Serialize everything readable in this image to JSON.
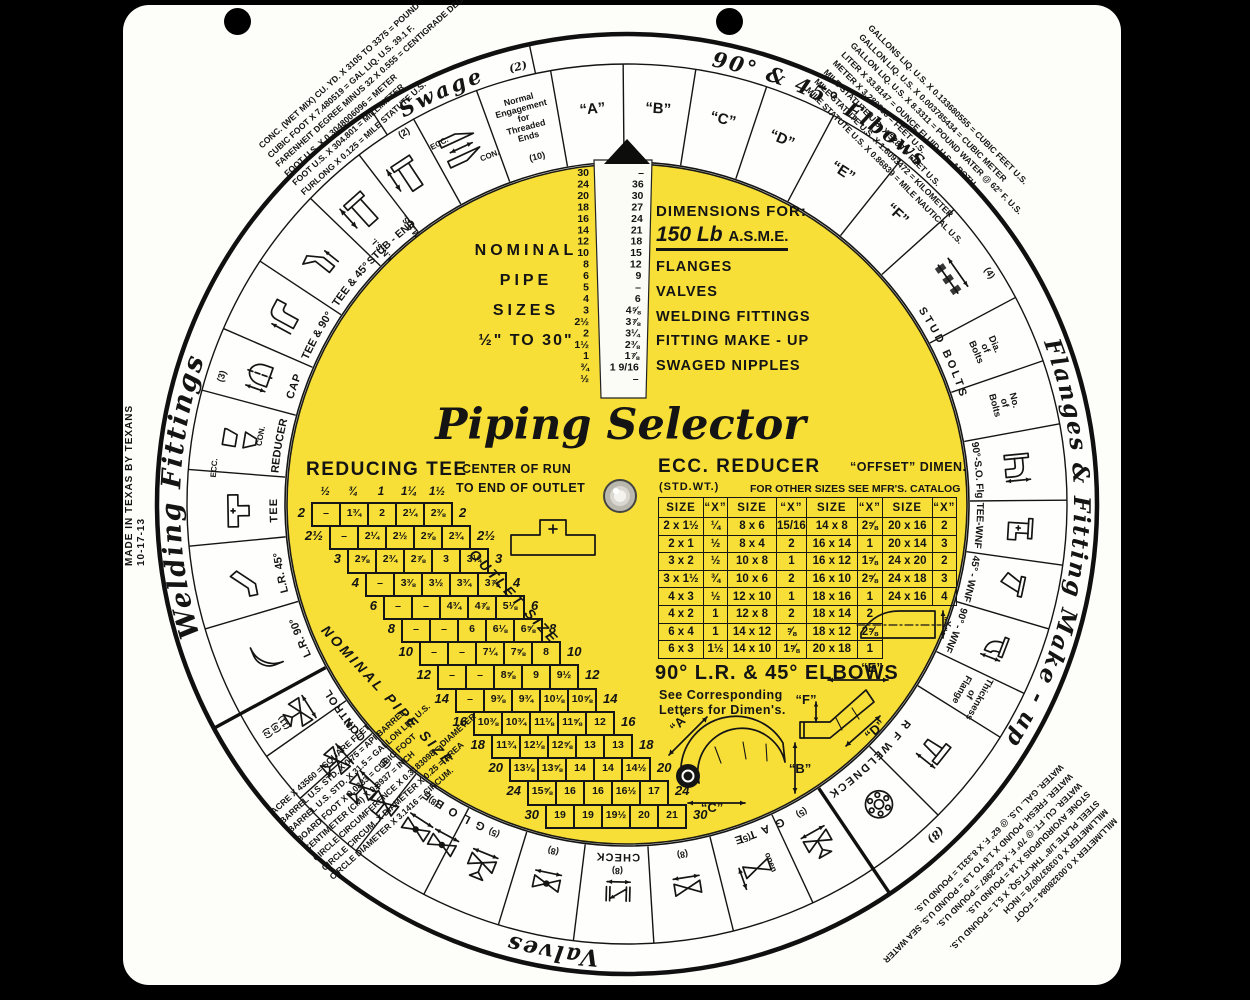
{
  "wheel": {
    "made_in": "MADE IN TEXAS BY TEXANS",
    "date_code": "10-17-13",
    "titles": {
      "welding_fittings": "Welding Fittings",
      "swage": "Swage",
      "swage_note": "(2)",
      "elbows_90_45": "90° & 45° Elbows",
      "flanges_make_up": "Flanges & Fitting Make - up",
      "flanges_note": "(8)",
      "valves": "Valves"
    },
    "letter_cells": [
      "“A”",
      "“B”",
      "“C”",
      "“D”",
      "“E”",
      "“F”"
    ],
    "cells": {
      "stub_end": "STUB - END",
      "ansi": "A.N.S.I.",
      "mss": "M.S.S.",
      "tee_45": "TEE & 45°",
      "tee_90": "TEE & 90°",
      "cap": "CAP",
      "reducer": "REDUCER",
      "ecc": "ECC.",
      "con": "CON.",
      "tee": "TEE",
      "lr_45": "L.R. 45°",
      "lr_90": "L.R. 90°",
      "control": "CONTROL",
      "globe": "GLOBE",
      "check": "CHECK",
      "gate": "GATE",
      "open": "open",
      "stud_bolts": "STUD BOLTS",
      "dia_of_bolts": [
        "Dia.",
        "of",
        "Bolts"
      ],
      "no_of_bolts": [
        "No.",
        "of",
        "Bolts"
      ],
      "so_flg_90": "90°-S.O. Flg",
      "tee_wnf": "TEE-WNF",
      "wnf_45": "45° - WNF",
      "wnf_90": "90° - WNF",
      "rf_weldneck": "R F WELDNECK",
      "thickness_of_flange": [
        "Thickness",
        "of",
        "Flange"
      ],
      "engagement": [
        "Normal",
        "Engagement",
        "for",
        "Threaded",
        "Ends"
      ],
      "engagement_note": "(10)",
      "notes": {
        "n2": "(2)",
        "n3": "(3)",
        "n4": "(4)",
        "n5": "(5)",
        "n8": "(8)",
        "n10": "(10)",
        "n11": "(11)",
        "control_stack": [
          "(2)",
          "(5)",
          "(11)"
        ]
      }
    },
    "corner_conversions": {
      "top_left": [
        "CONC. (WET MIX) CU. YD. X 3105 TO 3375 = POUND",
        "CUBIC FOOT X 7.480519 = GAL LIQ. U.S. 39.1 F.",
        "FARENHEIT DEGREE MINUS 32 X 0.555 = CENTIGRADE DEGREE",
        "FOOT U.S. X 0.3048006096 = METER",
        "FOOT U.S. X 304.801 = MILLIMETER",
        "FURLONG X 0.125 = MILE STATUTE U.S."
      ],
      "top_right": [
        "GALLONS LIQ. U.S. X 0.133680555 = CUBIC FEET U.S.",
        "GALLON LIQ. U.S. X 0.003785434 = CUBIC METER",
        "GALLON LIQ. U.S. X 8.3311 = POUND WATER @ 62° F. U.S.",
        "LITER X 33.8147 = OUNCE FLUID U.S. APOTH.",
        "METER X 3.280833 = FEET U.S.",
        "MILE STATUTE U.S. X 5280 = FEET U.S.",
        "MILE STATUTE U.S. X 1.6093472 = KILOMETER",
        "MILE STATUTE U.S. X 0.86839 = MILE NAUTICAL U.S."
      ],
      "bottom_left": [
        "ACRE X 43560 = SQUARE FEET",
        "BARREL U.S. STD. X 0.75 = API BARREL",
        "BARREL U.S. STD. X 31.5 = GALLON LIQ. U.S.",
        "BOARD FOOT X 0.0833 = CUBIC FOOT",
        "CENTIMETER (CM) X 0.3937 = INCH",
        "CIRCLE CIRCUMFERENCE X 0.3183098 = DIAMETER",
        "CIRCLE CIRCUM. X DIAMETER X 0.25 = AREA",
        "CIRCLE DIAMETER X 3.1416 = CIRCUM."
      ],
      "bottom_right": [
        "MILLIMETER X 0.00328084 = FOOT",
        "MILLIMETER X 0.039370078 = INCH",
        "STEEL PLATE 1/8\" THK.FT.SQ. X 5.1 = POUND U.S.",
        "STONE AVOIRDUPOIS X 14 = POUND U.S.",
        "WATER. CU. FT. @ 70° F. X 62.2987 = POUND U.S.",
        "WATER. FRESH. POUND X 1.6 TO 1.9 = POUND U.S. SEA WATER",
        "WATER. GAL. U.S. @ 62° F. X 8.3311 = POUND U.S."
      ]
    }
  },
  "disc": {
    "title": "Piping Selector",
    "copyright": "COPYRIGHT 1998 PIPING SELECTOR",
    "nominal": {
      "l1": "NOMINAL",
      "l2": "PIPE",
      "l3": "SIZES",
      "l4": "½\" TO 30\""
    },
    "dimensions_for": {
      "heading": "DIMENSIONS FOR:",
      "spec1": "150 Lb",
      "spec2": "A.S.M.E.",
      "items": [
        "FLANGES",
        "VALVES",
        "WELDING FITTINGS",
        "FITTING MAKE - UP",
        "SWAGED NIPPLES"
      ]
    },
    "slot": {
      "sizes": [
        "30",
        "24",
        "20",
        "18",
        "16",
        "14",
        "12",
        "10",
        "8",
        "6",
        "5",
        "4",
        "3",
        "2½",
        "2",
        "1½",
        "1",
        "¾",
        "½"
      ],
      "window": [
        "–",
        "36",
        "30",
        "27",
        "24",
        "21",
        "18",
        "15",
        "12",
        "9",
        "–",
        "6",
        "4⅝",
        "3⅞",
        "3¼",
        "2⅜",
        "1⅞",
        "1 9/16",
        "–"
      ]
    },
    "reducing_tee": {
      "title": "REDUCING TEE",
      "subtitle1": "CENTER OF RUN",
      "subtitle2": "TO END OF OUTLET",
      "col_headers": [
        "½",
        "¾",
        "1",
        "1¼",
        "1½"
      ],
      "rows": [
        {
          "label": "2",
          "cells": [
            "–",
            "1¾",
            "2",
            "2¼",
            "2⅜"
          ]
        },
        {
          "label": "2½",
          "cells": [
            "–",
            "2¼",
            "2½",
            "2⅝",
            "2¾"
          ]
        },
        {
          "label": "3",
          "cells": [
            "2⅝",
            "2¾",
            "2⅞",
            "3",
            "3¼"
          ]
        },
        {
          "label": "4",
          "cells": [
            "–",
            "3⅜",
            "3½",
            "3¾",
            "3⅞"
          ]
        },
        {
          "label": "6",
          "cells": [
            "–",
            "–",
            "4¾",
            "4⅞",
            "5⅛"
          ]
        },
        {
          "label": "8",
          "cells": [
            "–",
            "–",
            "6",
            "6⅛",
            "6⅝"
          ]
        },
        {
          "label": "10",
          "cells": [
            "–",
            "–",
            "7¼",
            "7⅝",
            "8"
          ]
        },
        {
          "label": "12",
          "cells": [
            "–",
            "–",
            "8⅝",
            "9",
            "9½"
          ]
        },
        {
          "label": "14",
          "cells": [
            "–",
            "9⅜",
            "9¾",
            "10⅛",
            "10⅝"
          ]
        },
        {
          "label": "16",
          "cells": [
            "10⅜",
            "10¾",
            "11⅛",
            "11⅝",
            "12"
          ]
        },
        {
          "label": "18",
          "cells": [
            "11¾",
            "12⅛",
            "12⅝",
            "13",
            "13"
          ]
        },
        {
          "label": "20",
          "cells": [
            "13⅛",
            "13⅝",
            "14",
            "14",
            "14½"
          ]
        },
        {
          "label": "24",
          "cells": [
            "15⅝",
            "16",
            "16",
            "16½",
            "17"
          ]
        },
        {
          "label": "30",
          "cells": [
            "19",
            "19",
            "19½",
            "20",
            "21"
          ]
        }
      ],
      "diag_outlet": "OUTLET SIZE",
      "diag_nominal": "NOMINAL PIPE SIZE"
    },
    "ecc_reducer": {
      "title": "ECC. REDUCER",
      "title2": "“OFFSET” DIMEN.",
      "sub1": "(STD.WT.)",
      "sub2": "FOR OTHER SIZES SEE MFR'S. CATALOG",
      "headers": [
        "SIZE",
        "“X”",
        "SIZE",
        "“X”",
        "SIZE",
        "“X”",
        "SIZE",
        "“X”"
      ],
      "rows": [
        [
          "2 x 1½",
          "¼",
          "8 x 6",
          "15/16",
          "14 x 8",
          "2⅝",
          "20 x 16",
          "2"
        ],
        [
          "2 x 1",
          "½",
          "8 x 4",
          "2",
          "16 x 14",
          "1",
          "20 x 14",
          "3"
        ],
        [
          "3 x 2",
          "½",
          "10 x 8",
          "1",
          "16 x 12",
          "1⅝",
          "24 x 20",
          "2"
        ],
        [
          "3 x 1½",
          "¾",
          "10 x 6",
          "2",
          "16 x 10",
          "2⅝",
          "24 x 18",
          "3"
        ],
        [
          "4 x 3",
          "½",
          "12 x 10",
          "1",
          "18 x 16",
          "1",
          "24 x 16",
          "4"
        ],
        [
          "4 x 2",
          "1",
          "12 x 8",
          "2",
          "18 x 14",
          "2",
          "",
          ""
        ],
        [
          "6 x 4",
          "1",
          "14 x 12",
          "⅝",
          "18 x 12",
          "2⅝",
          "",
          ""
        ],
        [
          "6 x 3",
          "1½",
          "14 x 10",
          "1⅝",
          "20 x 18",
          "1",
          "",
          ""
        ]
      ],
      "diagram_label": "“X”"
    },
    "elbows": {
      "title": "90° L.R. & 45° ELBOWS",
      "note1": "See Corresponding",
      "note2": "Letters for Dimen's.",
      "labels": [
        "“A”",
        "“B”",
        "“C”",
        "“D”",
        "“E”",
        "“F”"
      ]
    }
  }
}
